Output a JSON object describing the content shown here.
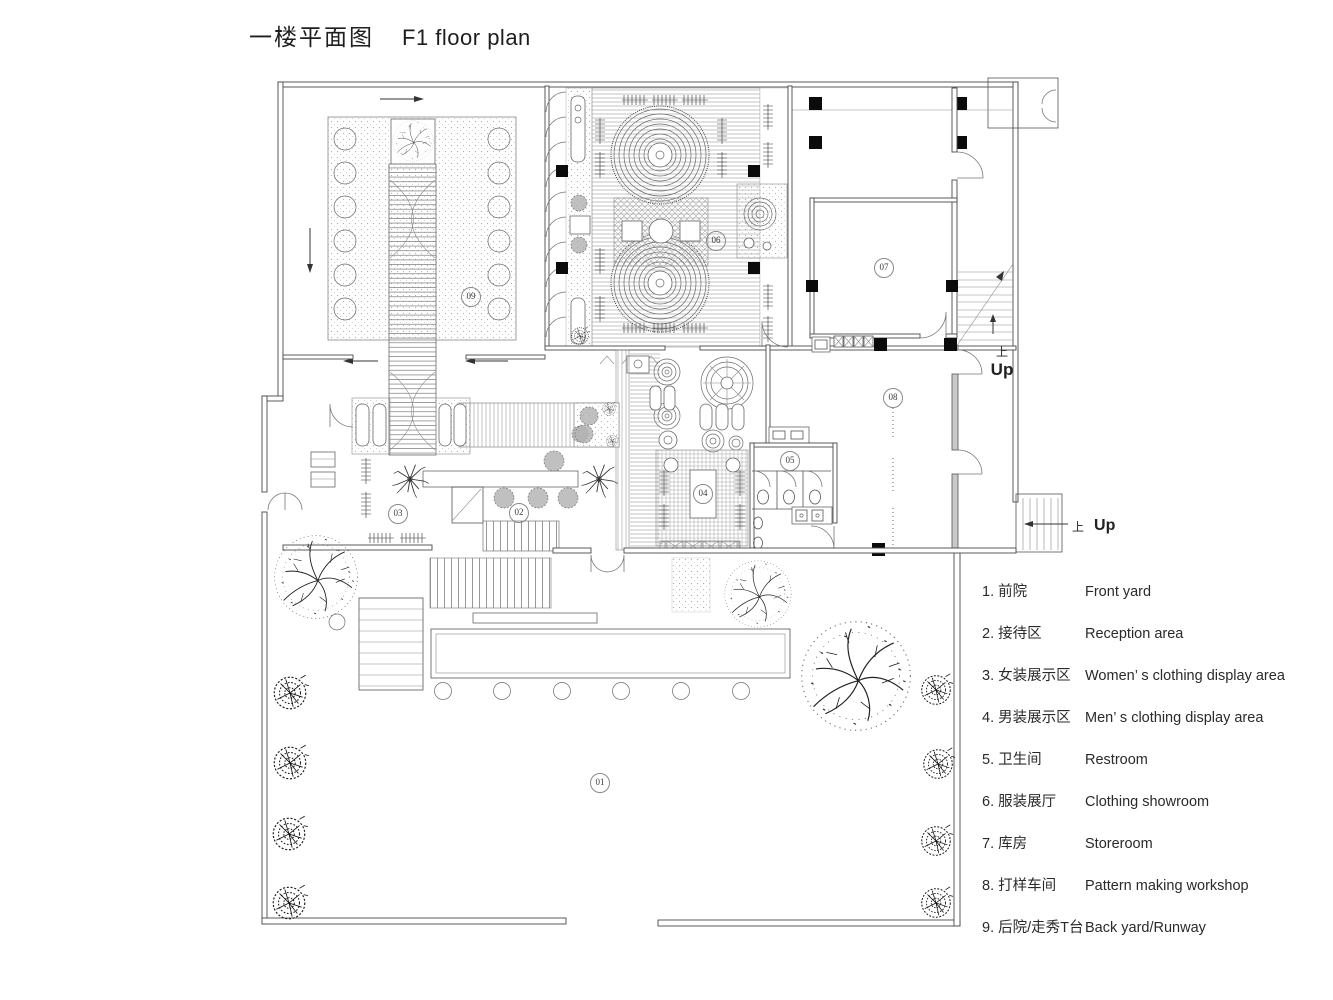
{
  "title": {
    "zh": "一楼平面图",
    "en": "F1 floor plan"
  },
  "plan": {
    "markers": [
      {
        "id": "01"
      },
      {
        "id": "02"
      },
      {
        "id": "03"
      },
      {
        "id": "04"
      },
      {
        "id": "05"
      },
      {
        "id": "06"
      },
      {
        "id": "07"
      },
      {
        "id": "08"
      },
      {
        "id": "09"
      }
    ],
    "stairs": [
      {
        "zh": "上",
        "en": "Up"
      },
      {
        "zh": "上",
        "en": "Up"
      }
    ]
  },
  "legend": {
    "items": [
      {
        "num": "1.",
        "zh": "前院",
        "en": "Front yard"
      },
      {
        "num": "2.",
        "zh": "接待区",
        "en": "Reception area"
      },
      {
        "num": "3.",
        "zh": "女装展示区",
        "en": "Women’ s clothing display area"
      },
      {
        "num": "4.",
        "zh": "男装展示区",
        "en": "Men’ s clothing display area"
      },
      {
        "num": "5.",
        "zh": "卫生间",
        "en": "Restroom"
      },
      {
        "num": "6.",
        "zh": "服装展厅",
        "en": "Clothing showroom"
      },
      {
        "num": "7.",
        "zh": "库房",
        "en": "Storeroom"
      },
      {
        "num": "8.",
        "zh": "打样车间",
        "en": "Pattern making workshop"
      },
      {
        "num": "9.",
        "zh": "后院/走秀T台",
        "en": "Back yard/Runway"
      }
    ]
  }
}
